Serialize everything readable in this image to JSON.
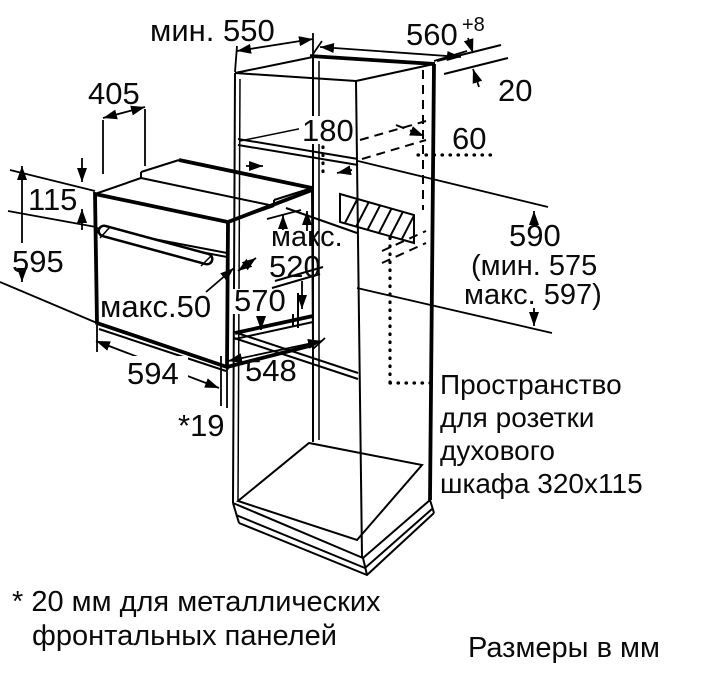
{
  "title": "Схема встраивания духового шкафа",
  "dimensions": {
    "min_depth": "мин. 550",
    "niche_width": "560",
    "niche_width_tol": "+8",
    "top_depth": "405",
    "shelf_height": "180",
    "rear_gap": "20",
    "socket_offset": "60",
    "panel_height": "115",
    "oven_height": "595",
    "max_label": "макс.",
    "niche_depth": "520",
    "body_height": "570",
    "handle_depth": "макс.50",
    "oven_width": "594",
    "oven_depth": "548",
    "front_overhang": "*19",
    "side_height": "590",
    "side_height_min": "(мин. 575",
    "side_height_max": "макс. 597)"
  },
  "socket_note": {
    "line1": "Пространство",
    "line2": "для розетки",
    "line3": "духового",
    "line4": "шкафа 320x115"
  },
  "footnote": {
    "line1": "* 20 мм для металлических",
    "line2": "фронтальных панелей"
  },
  "units_note": "Размеры в мм"
}
